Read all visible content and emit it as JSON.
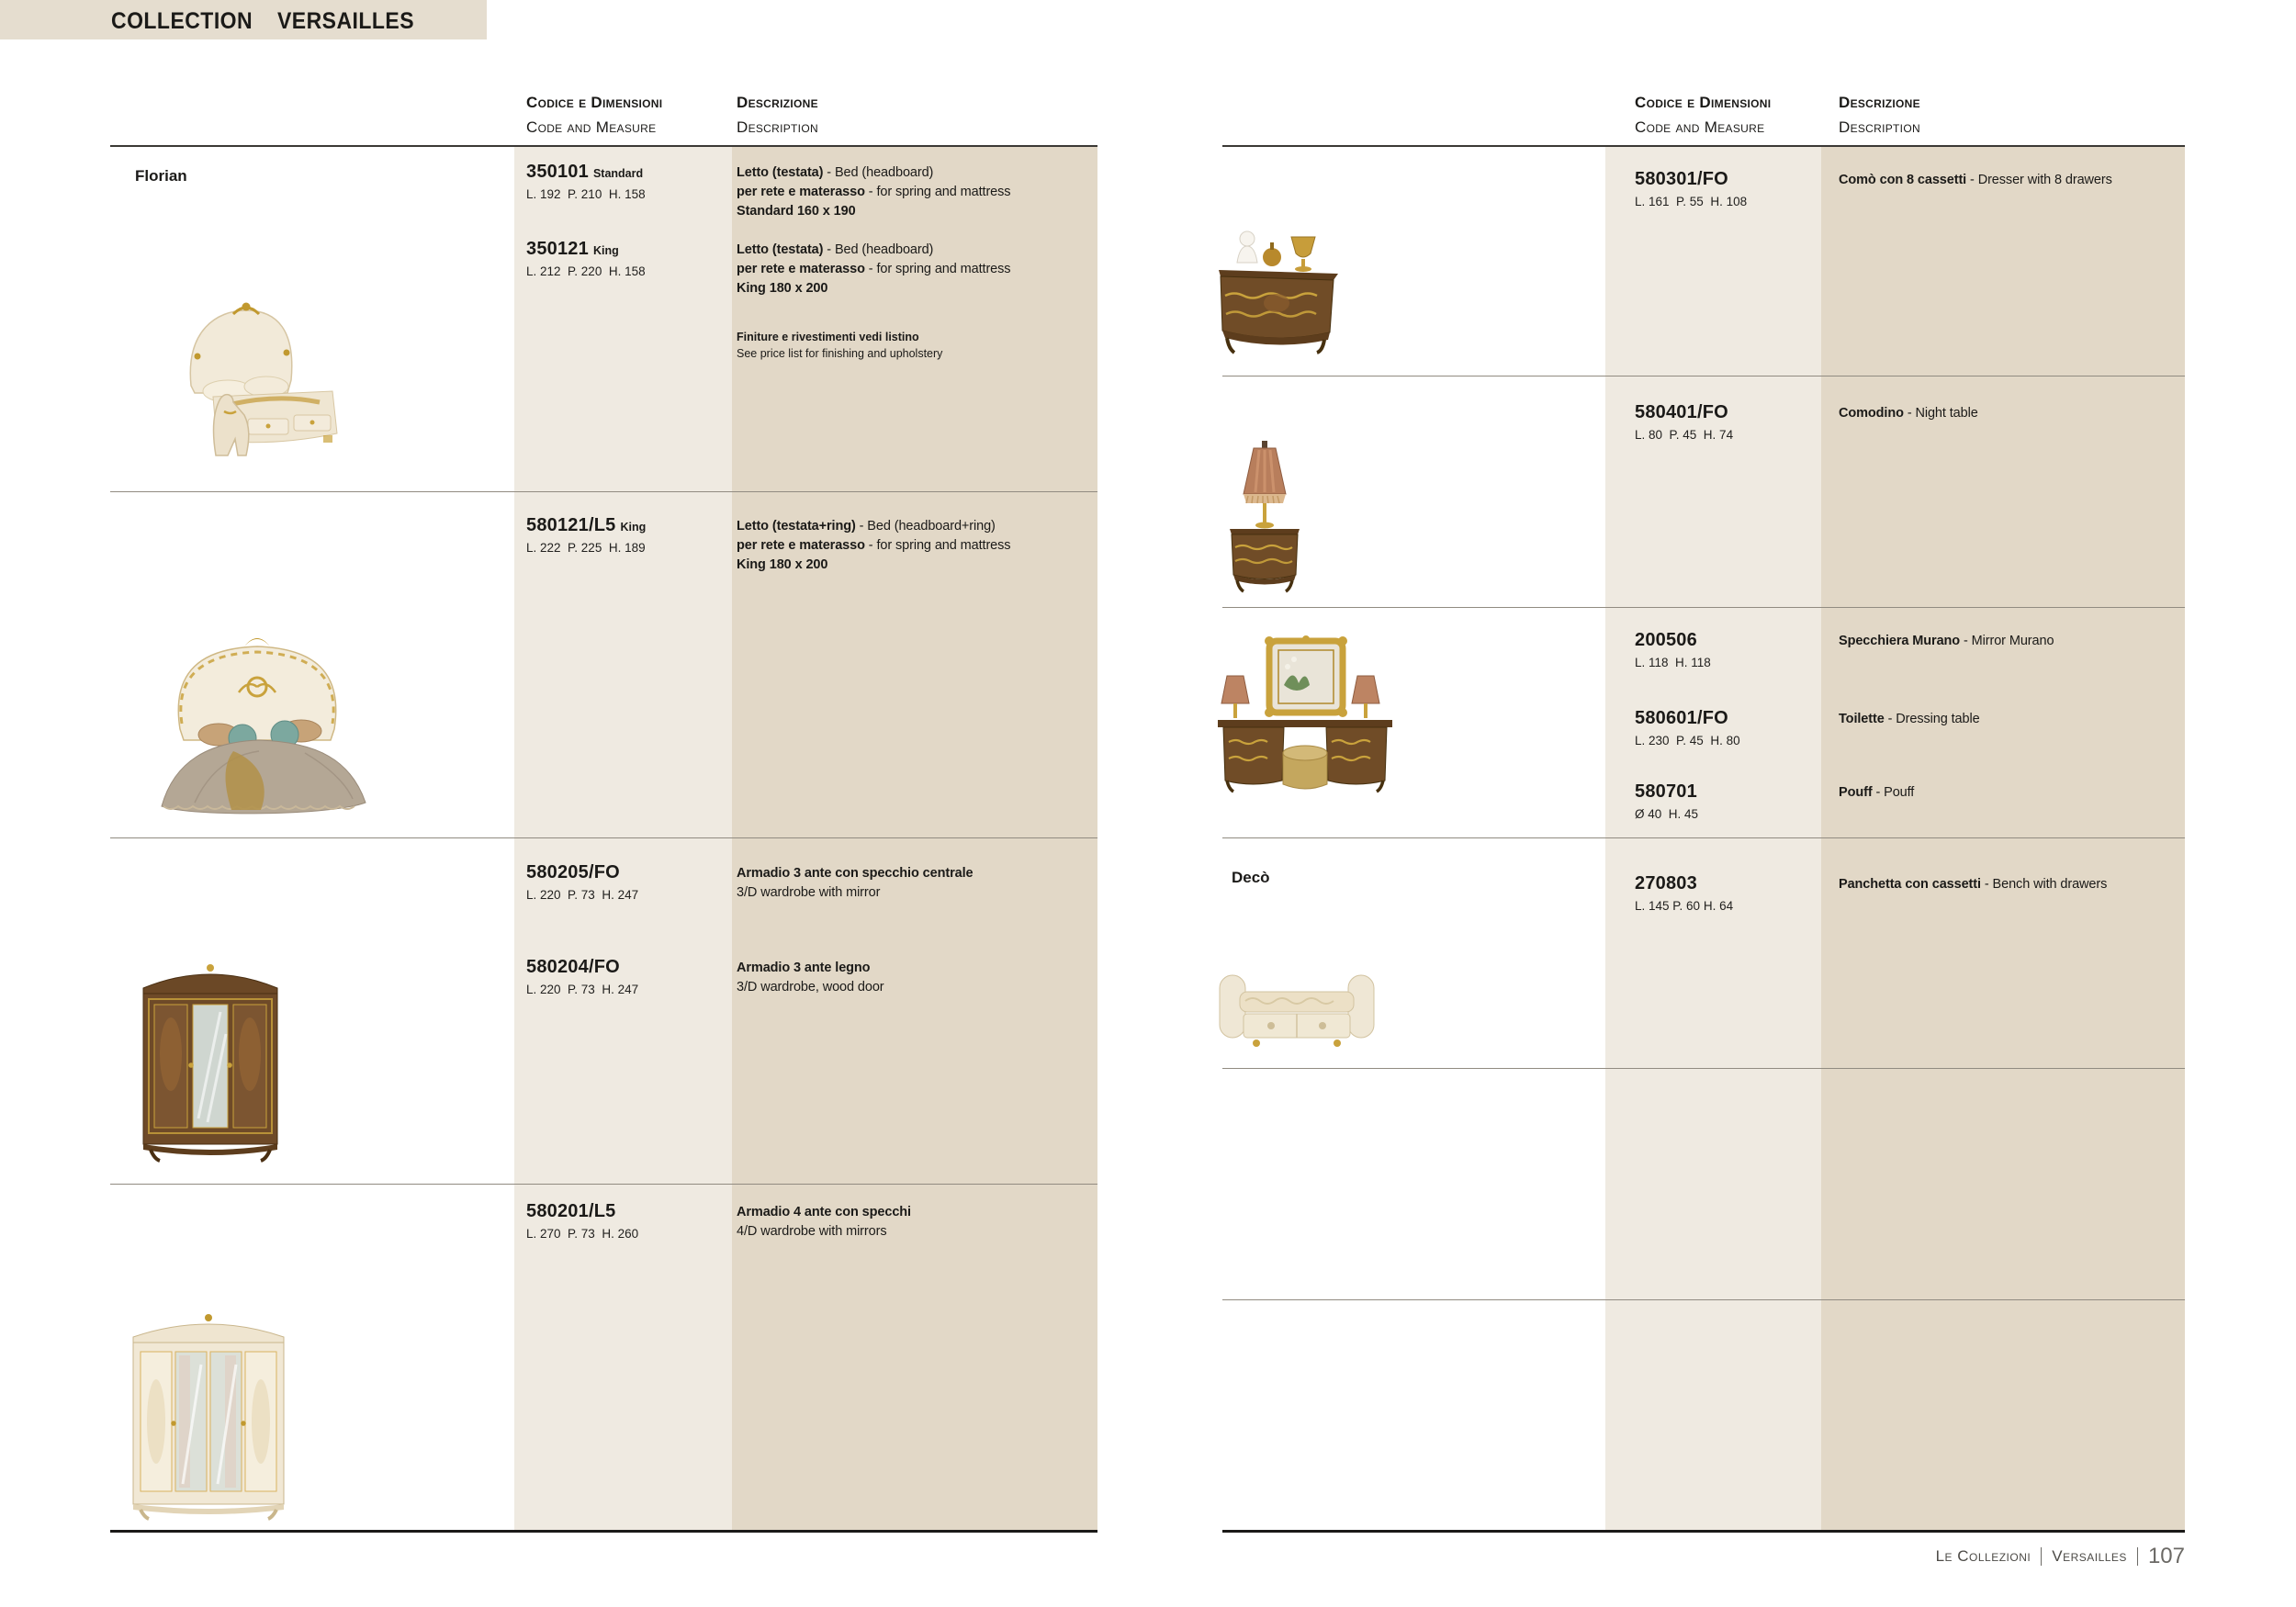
{
  "colors": {
    "title_bar_bg": "#e5ddcf",
    "code_col_bg": "#efeae1",
    "desc_col_bg": "#e2d8c7",
    "row_line": "#918b81",
    "header_line": "#3b3935",
    "bottom_line": "#1b1a18",
    "text": "#1b1a18",
    "footer_text": "#4c4a46"
  },
  "header": {
    "label": "COLLECTION",
    "name": "VERSAILLES"
  },
  "column_headers": {
    "code_it": "Codice e Dimensioni",
    "code_en": "Code and Measure",
    "desc_it": "Descrizione",
    "desc_en": "Description"
  },
  "left": {
    "section": "Florian",
    "rows": [
      {
        "photo": "upholstered-bed-with-dog-statue",
        "note_it": "Finiture e rivestimenti vedi listino",
        "note_en": "See price list for finishing and upholstery",
        "items": [
          {
            "code": "350101",
            "variant": "Standard",
            "dims": "L. 192  P. 210  H. 158",
            "desc": [
              [
                "Letto (testata)",
                " - Bed (headboard)"
              ],
              [
                "per rete e materasso",
                " - for spring and mattress"
              ],
              [
                "Standard 160 x 190",
                ""
              ]
            ]
          },
          {
            "code": "350121",
            "variant": "King",
            "dims": "L. 212  P. 220  H. 158",
            "desc": [
              [
                "Letto (testata)",
                " - Bed (headboard)"
              ],
              [
                "per rete e materasso",
                " - for spring and mattress"
              ],
              [
                "King 180 x 200",
                ""
              ]
            ]
          }
        ]
      },
      {
        "photo": "baroque-bed-with-draped-cover",
        "items": [
          {
            "code": "580121/L5",
            "variant": "King",
            "dims": "L. 222  P. 225  H. 189",
            "desc": [
              [
                "Letto (testata+ring)",
                " - Bed (headboard+ring)"
              ],
              [
                "per rete e materasso",
                " - for spring and mattress"
              ],
              [
                "King 180 x 200",
                ""
              ]
            ]
          }
        ]
      },
      {
        "photo": "three-door-wardrobe-walnut",
        "items": [
          {
            "code": "580205/FO",
            "variant": "",
            "dims": "L. 220  P. 73  H. 247",
            "desc": [
              [
                "Armadio 3 ante con specchio centrale",
                ""
              ],
              [
                "",
                "3/D wardrobe with mirror"
              ]
            ]
          },
          {
            "code": "580204/FO",
            "variant": "",
            "dims": "L. 220  P. 73  H. 247",
            "desc": [
              [
                "Armadio 3 ante legno",
                ""
              ],
              [
                "",
                "3/D wardrobe, wood door"
              ]
            ]
          }
        ]
      },
      {
        "photo": "four-door-wardrobe-ivory",
        "items": [
          {
            "code": "580201/L5",
            "variant": "",
            "dims": "L. 270  P. 73  H. 260",
            "desc": [
              [
                "Armadio 4 ante con specchi",
                ""
              ],
              [
                "",
                "4/D wardrobe with mirrors"
              ]
            ]
          }
        ]
      }
    ]
  },
  "right": {
    "section": "Decò",
    "rows": [
      {
        "photo": "dresser-with-bust-and-vases",
        "items": [
          {
            "code": "580301/FO",
            "variant": "",
            "dims": "L. 161  P. 55  H. 108",
            "desc": [
              [
                "Comò con 8 cassetti",
                " - Dresser with 8 drawers"
              ]
            ]
          }
        ]
      },
      {
        "photo": "night-table-with-lamp",
        "items": [
          {
            "code": "580401/FO",
            "variant": "",
            "dims": "L. 80  P. 45  H. 74",
            "desc": [
              [
                "Comodino",
                " - Night table"
              ]
            ]
          }
        ]
      },
      {
        "photo": "dressing-table-with-murano-mirror-and-pouf",
        "items": [
          {
            "code": "200506",
            "variant": "",
            "dims": "L. 118  H. 118",
            "desc": [
              [
                "Specchiera Murano",
                " - Mirror Murano"
              ]
            ]
          },
          {
            "code": "580601/FO",
            "variant": "",
            "dims": "L. 230  P. 45  H. 80",
            "desc": [
              [
                "Toilette",
                " - Dressing table"
              ]
            ]
          },
          {
            "code": "580701",
            "variant": "",
            "dims": "Ø 40  H. 45",
            "desc": [
              [
                "Pouff",
                " - Pouff"
              ]
            ]
          }
        ]
      },
      {
        "photo": "upholstered-bench-with-drawers",
        "items": [
          {
            "code": "270803",
            "variant": "",
            "dims": "L. 145 P. 60 H. 64",
            "desc": [
              [
                "Panchetta con cassetti",
                " - Bench with drawers"
              ]
            ]
          }
        ]
      }
    ]
  },
  "footer": {
    "series": "Le Collezioni",
    "collection": "Versailles",
    "page_number": "107"
  }
}
